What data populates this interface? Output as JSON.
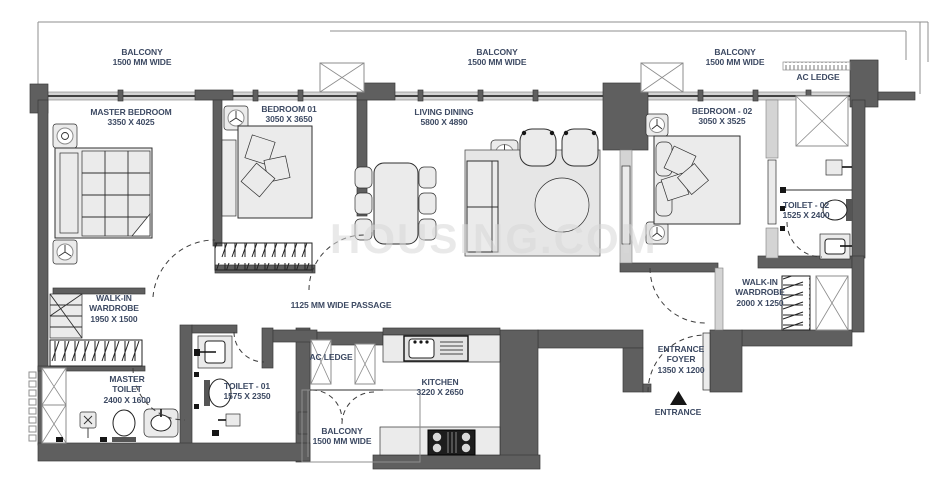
{
  "title": "Apartment Floor Plan",
  "watermark": "HOUSING.COM",
  "colors": {
    "wall": "#5f5f5f",
    "wall_stroke": "#3a3a3a",
    "window": "#d4d4d4",
    "furniture": "#ebebeb",
    "rug": "#e6e6e6",
    "label": "#3d4a63",
    "line": "#2f2f2f",
    "watermark": "#d8d8d8"
  },
  "entrance_marker": {
    "shape": "triangle-up",
    "color": "#161616"
  },
  "rooms": [
    {
      "id": "balcony-top-left",
      "lines": [
        "BALCONY",
        "1500 MM WIDE"
      ],
      "x": 142,
      "y": 47
    },
    {
      "id": "balcony-top-center",
      "lines": [
        "BALCONY",
        "1500 MM WIDE"
      ],
      "x": 497,
      "y": 47
    },
    {
      "id": "balcony-top-right",
      "lines": [
        "BALCONY",
        "1500 MM WIDE"
      ],
      "x": 735,
      "y": 47
    },
    {
      "id": "ac-ledge-top-right",
      "lines": [
        "AC LEDGE"
      ],
      "x": 818,
      "y": 72
    },
    {
      "id": "master-bedroom",
      "lines": [
        "MASTER BEDROOM",
        "3350 X 4025"
      ],
      "x": 131,
      "y": 107
    },
    {
      "id": "bedroom-01",
      "lines": [
        "BEDROOM 01",
        "3050 X 3650"
      ],
      "x": 289,
      "y": 104
    },
    {
      "id": "living-dining",
      "lines": [
        "LIVING DINING",
        "5800 X 4890"
      ],
      "x": 444,
      "y": 107
    },
    {
      "id": "bedroom-02",
      "lines": [
        "BEDROOM - 02",
        "3050 X 3525"
      ],
      "x": 722,
      "y": 106
    },
    {
      "id": "toilet-02",
      "lines": [
        "TOILET - 02",
        "1525 X 2400"
      ],
      "x": 806,
      "y": 200
    },
    {
      "id": "walk-in-wardrobe-1",
      "lines": [
        "WALK-IN",
        "WARDROBE",
        "1950 X 1500"
      ],
      "x": 114,
      "y": 293
    },
    {
      "id": "passage",
      "lines": [
        "1125 MM WIDE PASSAGE"
      ],
      "x": 341,
      "y": 300
    },
    {
      "id": "walk-in-wardrobe-2",
      "lines": [
        "WALK-IN",
        "WARDROBE",
        "2000 X 1250"
      ],
      "x": 760,
      "y": 277
    },
    {
      "id": "entrance-foyer",
      "lines": [
        "ENTRANCE",
        "FOYER",
        "1350 X 1200"
      ],
      "x": 681,
      "y": 344
    },
    {
      "id": "ac-ledge-bottom",
      "lines": [
        "AC LEDGE"
      ],
      "x": 331,
      "y": 352
    },
    {
      "id": "kitchen",
      "lines": [
        "KITCHEN",
        "3220 X 2650"
      ],
      "x": 440,
      "y": 377
    },
    {
      "id": "master-toilet",
      "lines": [
        "MASTER",
        "TOILET",
        "2400 X 1600"
      ],
      "x": 127,
      "y": 374
    },
    {
      "id": "toilet-01",
      "lines": [
        "TOILET - 01",
        "1575 X 2350"
      ],
      "x": 247,
      "y": 381
    },
    {
      "id": "balcony-bottom",
      "lines": [
        "BALCONY",
        "1500 MM WIDE"
      ],
      "x": 342,
      "y": 426
    },
    {
      "id": "entrance",
      "lines": [
        "ENTRANCE"
      ],
      "x": 678,
      "y": 407
    }
  ]
}
